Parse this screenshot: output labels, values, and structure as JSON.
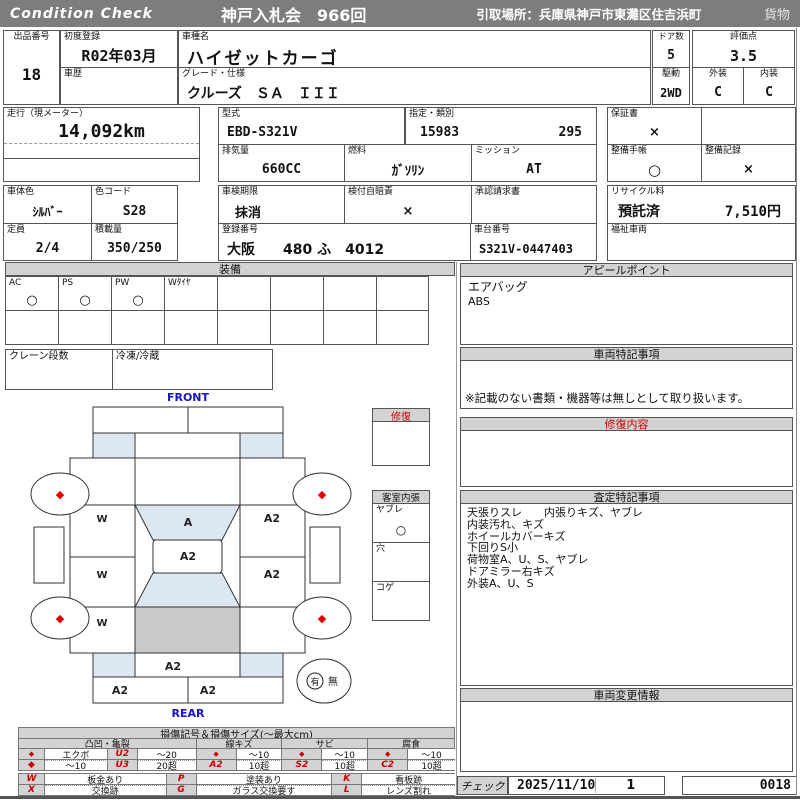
{
  "header": {
    "brand": "Condition  Check",
    "auction": "神戸入札会　966回",
    "pickup": "引取場所：兵庫県神戸市東灘区住吉浜町",
    "category": "貨物"
  },
  "info": {
    "lot_label": "出品番号",
    "lot_value": "18",
    "first_reg_label": "初度登録",
    "first_reg_value": "R02年03月",
    "history_label": "車歴",
    "model_label": "車種名",
    "model_value": "ハイゼットカーゴ",
    "grade_label": "グレード・仕様",
    "grade_value": "クルーズ　ＳＡ　ＩＩＩ",
    "doors_label": "ドア数",
    "doors_value": "5",
    "score_label": "評価点",
    "score_value": "3.5",
    "drive_label": "駆動",
    "drive_value": "2WD",
    "ext_label": "外装",
    "ext_value": "C",
    "int_label": "内装",
    "int_value": "C",
    "mileage_label": "走行（現メーター）",
    "mileage_value": "14,092km",
    "model_code_label": "型式",
    "model_code_value": "EBD-S321V",
    "class_label": "指定・類別",
    "class_value1": "15983",
    "class_value2": "295",
    "warranty_label": "保証書",
    "warranty_value": "×",
    "displacement_label": "排気量",
    "displacement_value": "660CC",
    "fuel_label": "燃料",
    "fuel_value": "ｶﾞｿﾘﾝ",
    "transmission_label": "ミッション",
    "transmission_value": "AT",
    "maint_book_label": "整備手帳",
    "maint_book_value": "○",
    "maint_rec_label": "整備記録",
    "maint_rec_value": "×",
    "color_label": "車体色",
    "color_value": "ｼﾙﾊﾞｰ",
    "color_code_label": "色コード",
    "color_code_value": "S28",
    "inspection_label": "車検期限",
    "inspection_value": "抹消",
    "insurance_label": "検付自賠責",
    "insurance_value": "×",
    "approval_label": "承認請求書",
    "recycle_label": "リサイクル料",
    "recycle_status": "預託済",
    "recycle_fee": "7,510円",
    "capacity_label": "定員",
    "capacity_value": "2/4",
    "load_label": "積載量",
    "load_value": "350/250",
    "reg_no_label": "登録番号",
    "reg_no_value": "大阪　　480 ふ　4012",
    "chassis_label": "車台番号",
    "chassis_value": "S321V-0447403",
    "welfare_label": "福祉車両"
  },
  "equipment": {
    "title": "装備",
    "c1": "AC",
    "v1": "○",
    "c2": "PS",
    "v2": "○",
    "c3": "PW",
    "v3": "○",
    "c4": "Wﾀｲﾔ",
    "crane_label": "クレーン段数",
    "fridge_label": "冷凍/冷蔵"
  },
  "appeal": {
    "title": "アピールポイント",
    "line1": "エアバッグ",
    "line2": "ABS"
  },
  "vehicle_notes": {
    "title": "車両特記事項",
    "note": "※記載のない書類・機器等は無しとして取り扱います。"
  },
  "repair": {
    "box_title": "修復",
    "content_title": "修復内容"
  },
  "cabin": {
    "title": "客室内張",
    "r1": "ヤブレ",
    "r1v": "○",
    "r2": "穴",
    "r3": "コゲ"
  },
  "assessment": {
    "title": "査定特記事項",
    "lines": [
      "天張りスレ　　内張りキズ、ヤブレ",
      "内装汚れ、キズ",
      "ホイールカバーキズ",
      "下回りS小",
      "荷物室A、U、S、ヤブレ",
      "ドアミラー右キズ",
      "外装A、U、S"
    ]
  },
  "change_info": {
    "title": "車両変更情報"
  },
  "check": {
    "label": "チェック",
    "date": "2025/11/10",
    "count": "1",
    "number": "0018"
  },
  "diagram": {
    "front": "FRONT",
    "rear": "REAR",
    "wheel_mark": "◆",
    "marks": {
      "windshield": "A",
      "roof": "A2",
      "right_upper": "A2",
      "right_lower": "A2",
      "left_1": "W",
      "left_2": "W",
      "left_3": "W",
      "rear_gate": "A2",
      "rear_bumper_left": "A2",
      "rear_bumper_right": "A2"
    },
    "spare_present": "有",
    "spare_absent": "無"
  },
  "legend": {
    "title": "損傷記号＆損傷サイズ(〜最大cm)",
    "g1": "凸凹・亀裂",
    "g2": "線キズ",
    "g3": "サビ",
    "g4": "腐食",
    "g1r1": [
      "◆",
      "エクボ",
      "U2",
      "〜20"
    ],
    "g1r2": [
      "◆",
      "〜10",
      "U3",
      "20超"
    ],
    "g2r1": [
      "◆",
      "〜10"
    ],
    "g2r2": [
      "A2",
      "10超"
    ],
    "g3r1": [
      "◆",
      "〜10"
    ],
    "g3r2": [
      "S2",
      "10超"
    ],
    "g4r1": [
      "◆",
      "〜10"
    ],
    "g4r2": [
      "C2",
      "10超"
    ],
    "w": "W",
    "w_desc": "板金あり",
    "x": "X",
    "x_desc": "交換跡",
    "p": "P",
    "p_desc": "塗装あり",
    "g": "G",
    "g_desc": "ガラス交換要す",
    "k": "K",
    "k_desc": "看板跡",
    "l": "L",
    "l_desc": "レンズ割れ"
  },
  "colors": {
    "accent_red": "#cc0000",
    "header_gray": "#7d7d7d",
    "glass_blue": "#dde7f2"
  }
}
